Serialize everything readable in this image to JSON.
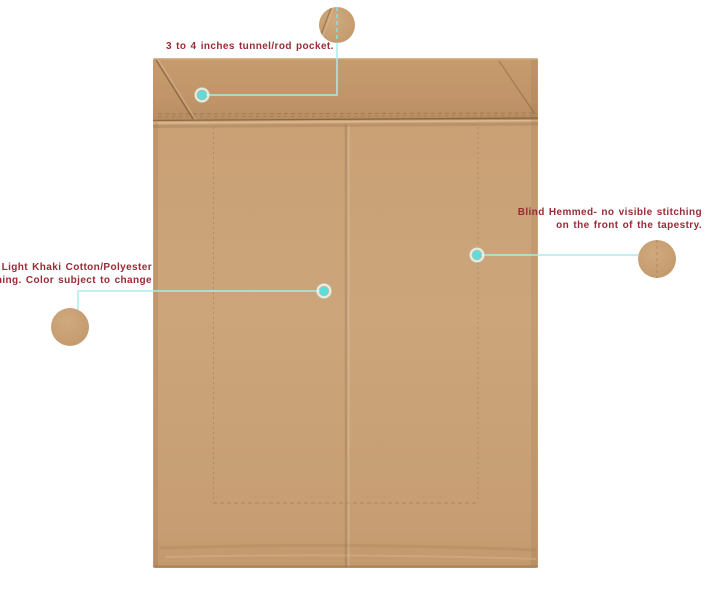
{
  "canvas": {
    "background": "#ffffff",
    "width": 706,
    "height": 600
  },
  "product_image": {
    "kind": "tapestry-back-view",
    "fabric_color": "#c9a077",
    "fabric_shadow": "#b68c62"
  },
  "annotations": {
    "label_color": "#9b2a36",
    "accent_color": "#58dedd",
    "leader_color": "#abecea",
    "rod_pocket": {
      "label": "3 to 4 inches tunnel/rod pocket.",
      "marker": "teal-dot-hotspot"
    },
    "blind_hem": {
      "lines": [
        "Blind Hemmed- no visible stitching",
        "on the front of the tapestry."
      ],
      "marker": "teal-dot-hotspot"
    },
    "lining": {
      "lines": [
        "Light Khaki Cotton/Polyester",
        "lining. Color subject to change"
      ],
      "marker": "teal-dot-hotspot"
    }
  }
}
